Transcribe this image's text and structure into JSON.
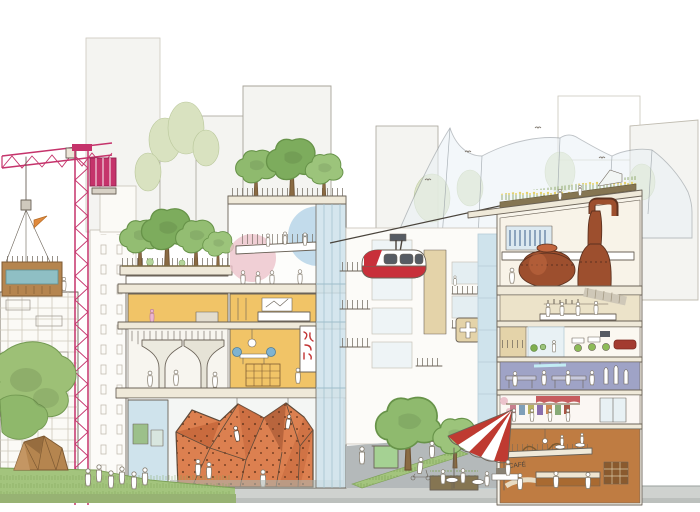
{
  "meta": {
    "title": "Hand-drawn urban district concept illustration (sectional streetscape)",
    "width": 700,
    "height": 512
  },
  "cafe": {
    "sign": "CAFÉ"
  },
  "scene": {
    "objects": [
      "magenta tower crane hoisting a timber housing module",
      "building under construction with modular blocks",
      "timber faceted pavilion on a lawn",
      "plaza with pedestrians",
      "center cutaway building: rooftop trees, community floor with mezzanine and blue/pink circles, yellow bedroom and living floors, vertical red-glyph banner, mushroom-column hall, orange indoor climbing wall with climbers, blue glass curtain wall",
      "red and white suspended cable-car gondola on a diagonal cable",
      "mid-rise facade with balconies, tan panel and white clinic cross",
      "street with large trees, green kiosk cart, planted median, pedestrians",
      "cafe with red/white striped fan awning, outdoor tables and barista",
      "right cutaway building: rooftop farm with crops and greenhouse, distillery with two copper stills, bar floor with ribbed duct, office floor with green chairs and red sofa, purple workshop floor, boutique floor with clothes rack, double-height restaurant with mezzanine and spiral ramp",
      "draped tent/netting canopy over rooftops with birds",
      "faint background towers and pale green trees"
    ]
  },
  "palette": {
    "paper": "#ffffff",
    "ink": "#6b6358",
    "inkSoft": "#b7b1a5",
    "distantFill": "#f4f4f1",
    "distantLine": "#a7a399",
    "bgTree": "#d9e2c0",
    "bgTreeLine": "#b9c79a",
    "craneRed": "#c5336b",
    "craneDark": "#8e2450",
    "wood": "#b5854f",
    "woodDark": "#7e5a33",
    "glassTeal": "#8fbfc4",
    "lawn": "#a3c47d",
    "lawnDark": "#7ea257",
    "tree": "#8fba6e",
    "treeLine": "#679349",
    "treeDark": "#7dac5d",
    "slab": "#efe9d9",
    "roomYellow": "#f1c467",
    "glassBlue": "#cfe3ec",
    "glassLine": "#9fbecb",
    "circleBlue": "#aecfe6",
    "circlePink": "#ecc3cc",
    "climb": "#dc8050",
    "climbDark": "#c4653a",
    "climbShadow": "#a85a35",
    "holdBrown": "#6b3a1f",
    "signRed": "#c23434",
    "gondolaRed": "#c8303a",
    "windowDark": "#565b63",
    "street": "#b4b9ba",
    "pavement": "#cfd2cf",
    "pavementEdge": "#9aa09e",
    "tan": "#e4d3a9",
    "copper": "#9d4f2e",
    "copperDark": "#5d3220",
    "copperLight": "#c2663f",
    "khaki": "#ece3c9",
    "purple": "#9fa3c6",
    "boutiqueRed": "#c04a4e",
    "restOrange": "#bf7c42",
    "restDeep": "#a96a31",
    "awningRed": "#bf3a31",
    "cream": "#f8f4ea",
    "farmYellow": "#e4d06a",
    "farmGreen": "#7f9c55",
    "soil": "#857552",
    "duct": "#cfc8b8",
    "posterGreen": "#9cc08a",
    "kioskGreen": "#a5d193",
    "sofaRed": "#a33b30",
    "chairGreen": "#8dbb57"
  }
}
